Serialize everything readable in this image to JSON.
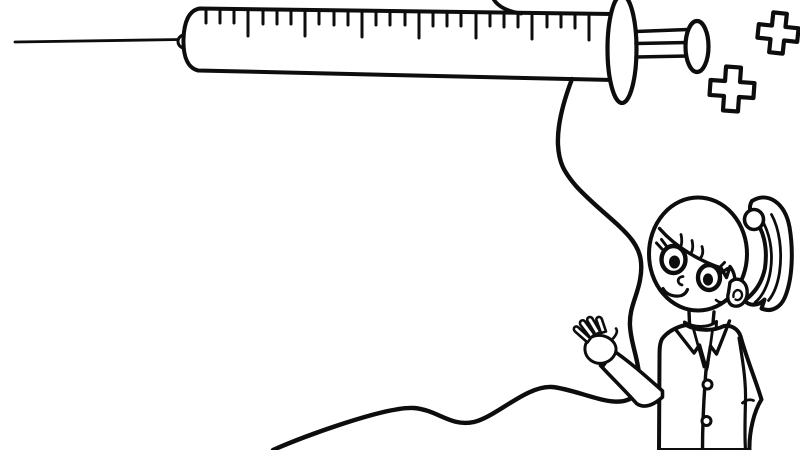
{
  "scene": {
    "background_color": "#ffffff",
    "line_color": "#0d0d0d",
    "description": "Black and white coloring-page style line drawing: a large syringe with scale tick marks at the top, a long winding IV tube flowing down and across the bottom, two outlined medical cross symbols at the top right, and a smiling girl with a ponytail wearing a lab coat waving at the bottom right."
  },
  "objects": {
    "syringe": {
      "label": "syringe with graduated scale, plunger and needle"
    },
    "iv_tube": {
      "label": "winding IV tube"
    },
    "crosses": {
      "count": 2,
      "label": "outlined medical plus crosses"
    },
    "girl": {
      "label": "girl in lab coat with ponytail, waving hand"
    }
  }
}
